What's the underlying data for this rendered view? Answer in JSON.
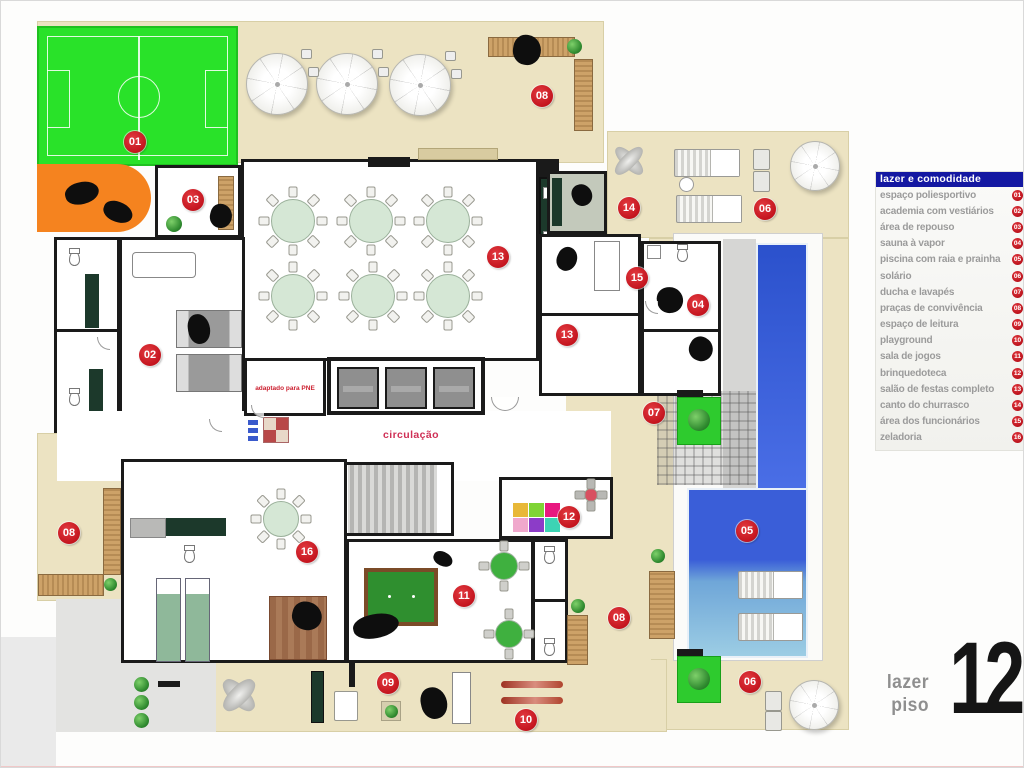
{
  "legend": {
    "title": "lazer e comodidade",
    "items": [
      {
        "num": "01",
        "label": "espaço poliesportivo"
      },
      {
        "num": "02",
        "label": "academia com vestiários"
      },
      {
        "num": "03",
        "label": "área de repouso"
      },
      {
        "num": "04",
        "label": "sauna à vapor"
      },
      {
        "num": "05",
        "label": "piscina com raia e prainha"
      },
      {
        "num": "06",
        "label": "solário"
      },
      {
        "num": "07",
        "label": "ducha e lavapés"
      },
      {
        "num": "08",
        "label": "praças de convivência"
      },
      {
        "num": "09",
        "label": "espaço de leitura"
      },
      {
        "num": "10",
        "label": "playground"
      },
      {
        "num": "11",
        "label": "sala de jogos"
      },
      {
        "num": "12",
        "label": "brinquedoteca"
      },
      {
        "num": "13",
        "label": "salão de festas completo"
      },
      {
        "num": "14",
        "label": "canto do churrasco"
      },
      {
        "num": "15",
        "label": "área dos funcionários"
      },
      {
        "num": "16",
        "label": "zeladoria"
      }
    ]
  },
  "markers": [
    {
      "num": "01",
      "x": 134,
      "y": 141
    },
    {
      "num": "02",
      "x": 149,
      "y": 354
    },
    {
      "num": "03",
      "x": 192,
      "y": 199
    },
    {
      "num": "04",
      "x": 697,
      "y": 304
    },
    {
      "num": "05",
      "x": 746,
      "y": 530
    },
    {
      "num": "06",
      "x": 764,
      "y": 208
    },
    {
      "num": "06",
      "x": 749,
      "y": 681
    },
    {
      "num": "07",
      "x": 653,
      "y": 412
    },
    {
      "num": "08",
      "x": 541,
      "y": 95
    },
    {
      "num": "08",
      "x": 68,
      "y": 532
    },
    {
      "num": "08",
      "x": 618,
      "y": 617
    },
    {
      "num": "09",
      "x": 387,
      "y": 682
    },
    {
      "num": "10",
      "x": 525,
      "y": 719
    },
    {
      "num": "11",
      "x": 463,
      "y": 595
    },
    {
      "num": "12",
      "x": 568,
      "y": 516
    },
    {
      "num": "13",
      "x": 497,
      "y": 256
    },
    {
      "num": "13",
      "x": 566,
      "y": 334
    },
    {
      "num": "14",
      "x": 628,
      "y": 207
    },
    {
      "num": "15",
      "x": 636,
      "y": 277
    },
    {
      "num": "16",
      "x": 306,
      "y": 551
    }
  ],
  "labels": {
    "circulation": "circulação",
    "pne_bathroom": "adaptado para PNE"
  },
  "logo": {
    "line1": "lazer",
    "line2": "piso",
    "number": "12"
  },
  "colors": {
    "marker_red": "#c2121c",
    "legend_blue": "#1418a2",
    "court_green": "#29e229",
    "accent_orange": "#f5831f",
    "pool_blue": "#3a5ed8",
    "pool_shallow": "#93c8e2"
  }
}
